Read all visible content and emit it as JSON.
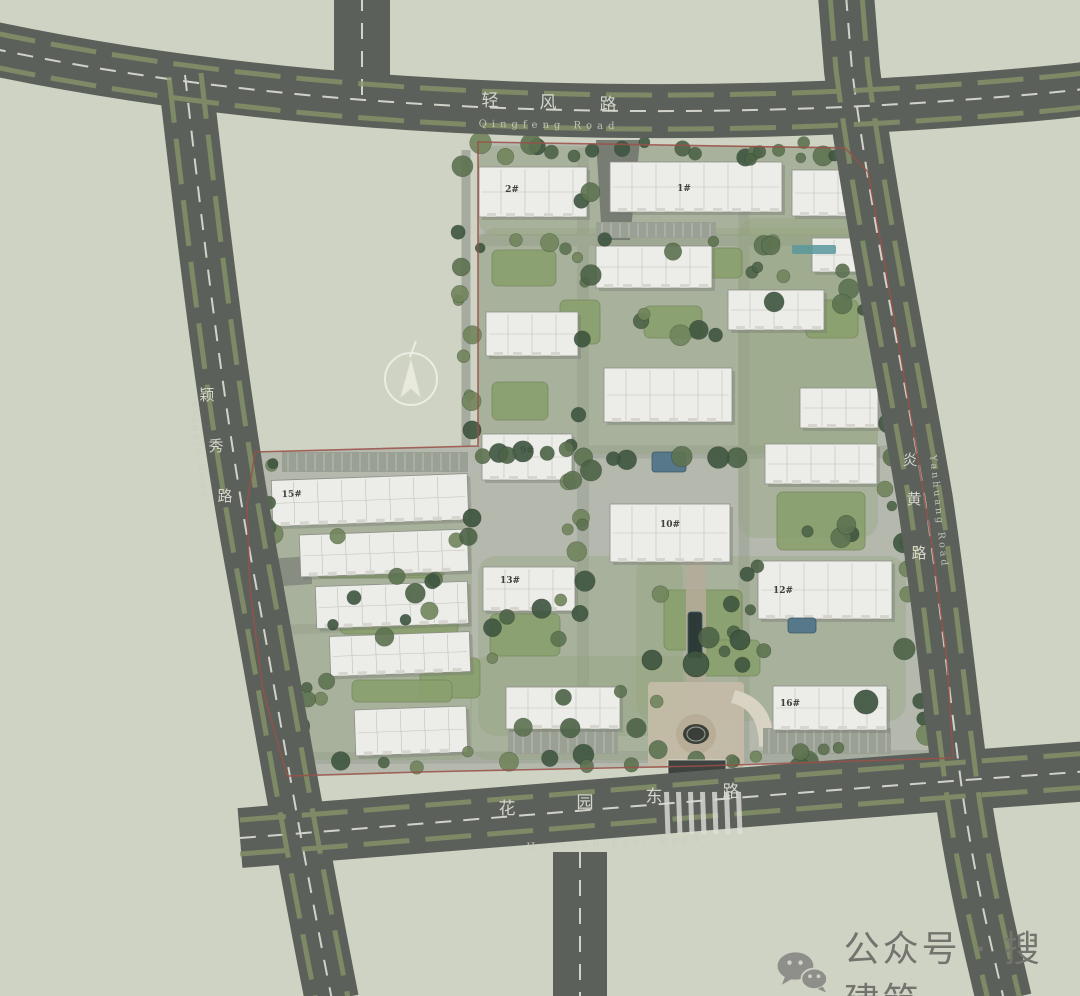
{
  "title": "residential-master-site-plan",
  "roads": {
    "qingfeng": {
      "cn": "轻风路",
      "en": "Qingfeng Road"
    },
    "huayuan": {
      "cn": "花园东路",
      "en": "Huayuan East Road"
    },
    "yingxiu": {
      "cn": "颖秀路",
      "en": "Yingxiu Road"
    },
    "yanhuang": {
      "cn": "炎黄路",
      "en": "Yanhuang Road"
    }
  },
  "watermark": {
    "text": "公众号 · 搜建筑",
    "icon": "wechat-icon"
  },
  "colors": {
    "background": "#cfd3c4",
    "road": "#5b615a",
    "road_median": "#87936a",
    "lane_line": "#e6e6de",
    "site_paving": "#b4b8ad",
    "inner_road": "#a6ab9f",
    "building": "#ecece8",
    "lawn": "#8aa06d",
    "tree_palette": [
      "#4d6347",
      "#5d7351",
      "#71855c",
      "#3f5640"
    ],
    "water": "#56788a",
    "dark_pool": "#2e3a38",
    "boundary_red": "#9a5048",
    "plaza_beige": "#c3baa6",
    "teal_annotation": "#59989c"
  },
  "buildings": [
    {
      "x": 610,
      "y": 162,
      "w": 172,
      "h": 50,
      "label": "1#",
      "lx": 684,
      "ly": 191,
      "angle": 0
    },
    {
      "x": 479,
      "y": 167,
      "w": 108,
      "h": 50,
      "label": "2#",
      "lx": 512,
      "ly": 192,
      "angle": 0
    },
    {
      "x": 792,
      "y": 170,
      "w": 86,
      "h": 46,
      "label": "",
      "angle": 0
    },
    {
      "x": 596,
      "y": 246,
      "w": 116,
      "h": 42,
      "label": "",
      "angle": 0
    },
    {
      "x": 812,
      "y": 238,
      "w": 58,
      "h": 34,
      "label": "",
      "angle": 0
    },
    {
      "x": 728,
      "y": 290,
      "w": 96,
      "h": 40,
      "label": "",
      "angle": 0
    },
    {
      "x": 486,
      "y": 312,
      "w": 92,
      "h": 44,
      "label": "",
      "angle": 0
    },
    {
      "x": 604,
      "y": 368,
      "w": 128,
      "h": 54,
      "label": "",
      "angle": 0
    },
    {
      "x": 800,
      "y": 388,
      "w": 78,
      "h": 40,
      "label": "",
      "angle": 0
    },
    {
      "x": 482,
      "y": 434,
      "w": 90,
      "h": 46,
      "label": "9#",
      "lx": 527,
      "ly": 453,
      "angle": 0
    },
    {
      "x": 765,
      "y": 444,
      "w": 112,
      "h": 40,
      "label": "",
      "angle": 0
    },
    {
      "x": 610,
      "y": 504,
      "w": 120,
      "h": 58,
      "label": "10#",
      "lx": 670,
      "ly": 527,
      "angle": 0
    },
    {
      "x": 758,
      "y": 561,
      "w": 134,
      "h": 58,
      "label": "12#",
      "lx": 783,
      "ly": 593,
      "angle": 0
    },
    {
      "x": 483,
      "y": 567,
      "w": 92,
      "h": 44,
      "label": "13#",
      "lx": 510,
      "ly": 583,
      "angle": 0
    },
    {
      "x": 272,
      "y": 477,
      "w": 196,
      "h": 46,
      "label": "15#",
      "lx": 292,
      "ly": 494,
      "angle": -2
    },
    {
      "x": 300,
      "y": 532,
      "w": 168,
      "h": 42,
      "label": "",
      "angle": -2
    },
    {
      "x": 316,
      "y": 584,
      "w": 152,
      "h": 42,
      "label": "",
      "angle": -2
    },
    {
      "x": 330,
      "y": 634,
      "w": 140,
      "h": 40,
      "label": "",
      "angle": -2
    },
    {
      "x": 355,
      "y": 708,
      "w": 112,
      "h": 46,
      "label": "",
      "angle": -2
    },
    {
      "x": 506,
      "y": 687,
      "w": 114,
      "h": 42,
      "label": "",
      "angle": 0
    },
    {
      "x": 773,
      "y": 686,
      "w": 114,
      "h": 44,
      "label": "16#",
      "lx": 790,
      "ly": 706,
      "angle": 0
    }
  ],
  "lawns": [
    {
      "x": 492,
      "y": 250,
      "w": 64,
      "h": 36
    },
    {
      "x": 644,
      "y": 306,
      "w": 58,
      "h": 32
    },
    {
      "x": 492,
      "y": 382,
      "w": 56,
      "h": 38
    },
    {
      "x": 777,
      "y": 492,
      "w": 88,
      "h": 58
    },
    {
      "x": 490,
      "y": 614,
      "w": 70,
      "h": 42
    },
    {
      "x": 420,
      "y": 658,
      "w": 60,
      "h": 40
    },
    {
      "x": 664,
      "y": 590,
      "w": 78,
      "h": 60
    },
    {
      "x": 316,
      "y": 548,
      "w": 128,
      "h": 30
    },
    {
      "x": 340,
      "y": 606,
      "w": 118,
      "h": 28
    },
    {
      "x": 700,
      "y": 640,
      "w": 60,
      "h": 36
    },
    {
      "x": 806,
      "y": 300,
      "w": 52,
      "h": 38
    },
    {
      "x": 536,
      "y": 700,
      "w": 58,
      "h": 32
    },
    {
      "x": 352,
      "y": 680,
      "w": 100,
      "h": 22
    },
    {
      "x": 690,
      "y": 248,
      "w": 52,
      "h": 30
    },
    {
      "x": 560,
      "y": 300,
      "w": 40,
      "h": 44
    }
  ],
  "soft_greens": [
    {
      "x": 478,
      "y": 228,
      "w": 400,
      "h": 226
    },
    {
      "x": 478,
      "y": 556,
      "w": 205,
      "h": 180
    },
    {
      "x": 636,
      "y": 556,
      "w": 270,
      "h": 165
    },
    {
      "x": 258,
      "y": 498,
      "w": 214,
      "h": 262
    },
    {
      "x": 738,
      "y": 218,
      "w": 140,
      "h": 320
    },
    {
      "x": 470,
      "y": 656,
      "w": 230,
      "h": 104
    },
    {
      "x": 478,
      "y": 146,
      "w": 396,
      "h": 90
    }
  ],
  "parking": [
    {
      "x": 508,
      "y": 730,
      "w": 110,
      "h": 24
    },
    {
      "x": 763,
      "y": 728,
      "w": 128,
      "h": 26
    },
    {
      "x": 282,
      "y": 452,
      "w": 186,
      "h": 20
    },
    {
      "x": 596,
      "y": 222,
      "w": 120,
      "h": 16
    }
  ],
  "water": [
    {
      "type": "pool",
      "x": 652,
      "y": 452,
      "w": 34,
      "h": 20
    },
    {
      "type": "pool",
      "x": 788,
      "y": 618,
      "w": 28,
      "h": 15
    },
    {
      "type": "dark-linear-pool",
      "x": 688,
      "y": 612,
      "w": 14,
      "h": 46
    }
  ],
  "fountain": {
    "cx": 696,
    "cy": 734,
    "rx": 13,
    "ry": 10
  },
  "annotations": [
    {
      "name": "teal-annotation",
      "x": 792,
      "y": 245,
      "w": 44,
      "h": 9
    }
  ],
  "trees": {
    "seed": 7,
    "bands": [
      {
        "x": 476,
        "y": 142,
        "w": 396,
        "h": 16,
        "n": 15
      },
      {
        "x": 856,
        "y": 180,
        "w": 36,
        "h": 140,
        "n": 8
      },
      {
        "x": 880,
        "y": 330,
        "w": 36,
        "h": 160,
        "n": 9
      },
      {
        "x": 900,
        "y": 500,
        "w": 40,
        "h": 170,
        "n": 9
      },
      {
        "x": 912,
        "y": 665,
        "w": 34,
        "h": 100,
        "n": 6
      },
      {
        "x": 290,
        "y": 746,
        "w": 560,
        "h": 22,
        "n": 20
      },
      {
        "x": 250,
        "y": 455,
        "w": 26,
        "h": 280,
        "n": 10
      },
      {
        "x": 455,
        "y": 150,
        "w": 20,
        "h": 290,
        "n": 9
      },
      {
        "x": 565,
        "y": 155,
        "w": 26,
        "h": 590,
        "n": 18
      },
      {
        "x": 480,
        "y": 238,
        "w": 380,
        "h": 14,
        "n": 10
      },
      {
        "x": 480,
        "y": 446,
        "w": 440,
        "h": 16,
        "n": 12
      },
      {
        "x": 640,
        "y": 298,
        "w": 80,
        "h": 40,
        "n": 5
      },
      {
        "x": 300,
        "y": 518,
        "w": 170,
        "h": 124,
        "n": 12
      },
      {
        "x": 480,
        "y": 598,
        "w": 120,
        "h": 62,
        "n": 6
      },
      {
        "x": 650,
        "y": 558,
        "w": 120,
        "h": 112,
        "n": 10
      },
      {
        "x": 740,
        "y": 238,
        "w": 130,
        "h": 72,
        "n": 8
      },
      {
        "x": 480,
        "y": 688,
        "w": 180,
        "h": 42,
        "n": 6
      },
      {
        "x": 790,
        "y": 488,
        "w": 110,
        "h": 52,
        "n": 5
      },
      {
        "x": 742,
        "y": 150,
        "w": 120,
        "h": 14,
        "n": 6
      },
      {
        "x": 262,
        "y": 680,
        "w": 80,
        "h": 70,
        "n": 6
      }
    ],
    "specimen": [
      [
        696,
        664,
        13
      ],
      [
        740,
        640,
        10
      ],
      [
        652,
        660,
        10
      ],
      [
        866,
        702,
        12
      ],
      [
        300,
        762,
        10
      ],
      [
        252,
        472,
        10
      ],
      [
        472,
        518,
        9
      ],
      [
        472,
        430,
        9
      ]
    ]
  },
  "north_arrow": {
    "cx": 411,
    "cy": 379,
    "r": 26
  }
}
